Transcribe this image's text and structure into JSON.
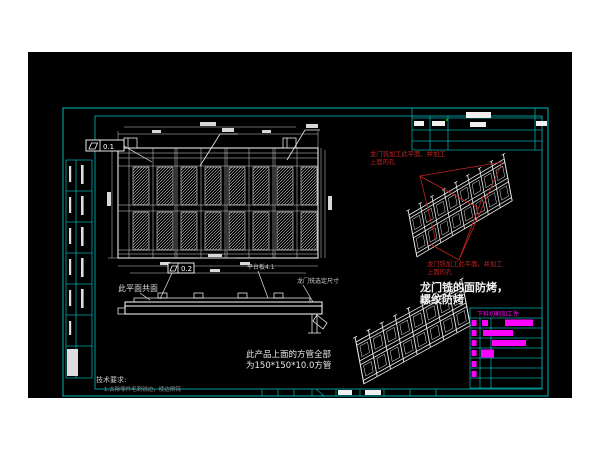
{
  "app": {
    "background": "#000000",
    "frame_color": "#00a8a8",
    "line_color": "#ffffff",
    "accent_red": "#c42222",
    "accent_magenta": "#ff00ff"
  },
  "annotations": {
    "flatness_1": {
      "symbol": "flatness",
      "value": "0.1"
    },
    "flatness_2": {
      "symbol": "flatness",
      "value": "0.2"
    },
    "coplanar_note": "此平面共面",
    "platform_note": "平台板4.1",
    "gantry_size_note": "龙门铣选定尺寸",
    "red_note_top_line1": "龙门铣加工此平面，并加工",
    "red_note_top_line2": "上面的孔",
    "red_note_bottom_line1": "龙门铣加工此平面，并加工",
    "red_note_bottom_line2": "上面的孔",
    "face_note_line1": "龙门铣的面防烤，",
    "face_note_line2": "螺纹防烤",
    "tube_note_line1": "此产品上面的方管全部",
    "tube_note_line2": "为150*150*10.0方管",
    "tech_req_title": "技术要求:",
    "tech_req_item": "1.去除零件毛刺锐边，棱边倒钝",
    "parts_table_header": "下料切割加工件"
  }
}
